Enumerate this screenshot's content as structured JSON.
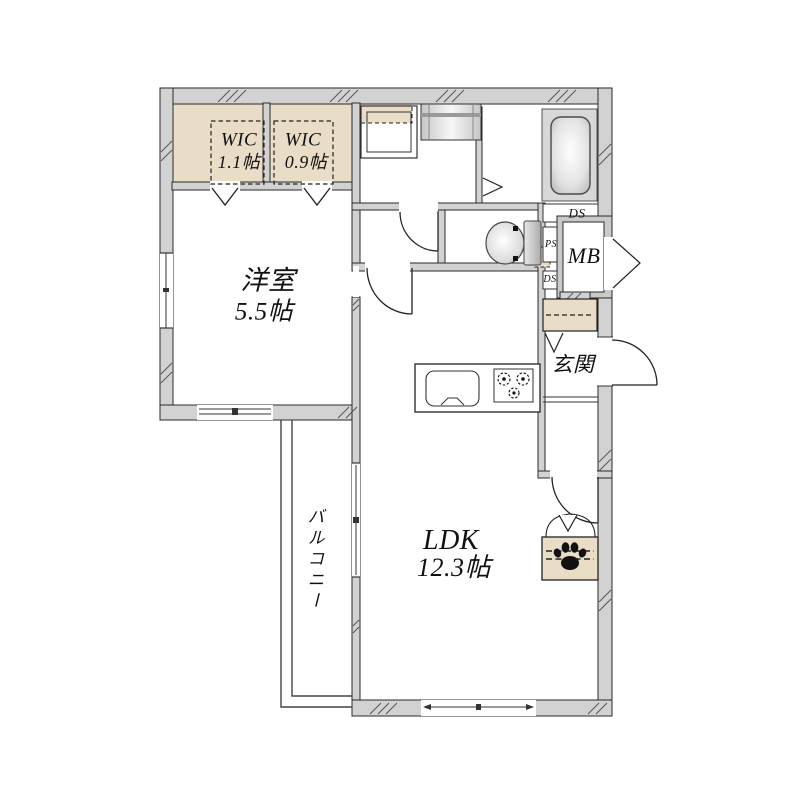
{
  "plan": {
    "wic1": {
      "label": "WIC",
      "area": "1.1帖"
    },
    "wic2": {
      "label": "WIC",
      "area": "0.9帖"
    },
    "western_room": {
      "label": "洋室",
      "area": "5.5帖"
    },
    "ldk": {
      "label": "LDK",
      "area": "12.3帖"
    },
    "balcony": {
      "label": "バルコニー"
    },
    "entrance": {
      "label": "玄関"
    },
    "meter_box": {
      "label": "MB"
    },
    "pipe_space": {
      "label": "PS"
    },
    "duct_space_bath": {
      "label": "DS"
    },
    "duct_space_mid": {
      "label": "DS"
    },
    "colors": {
      "wall": "#d2d2d2",
      "closet_fill": "#eaddc7",
      "bath_zone": "#d8d8d8",
      "line": "#222222",
      "paw": "#111111"
    },
    "icons": {
      "bathtub": "bathtub-icon",
      "toilet": "toilet-icon",
      "washbasin": "washbasin-icon",
      "washing_machine_pan": "washing-machine-pan-icon",
      "kitchen_sink": "kitchen-sink-icon",
      "stove": "stove-burners-icon",
      "paw": "paw-print-icon"
    }
  }
}
